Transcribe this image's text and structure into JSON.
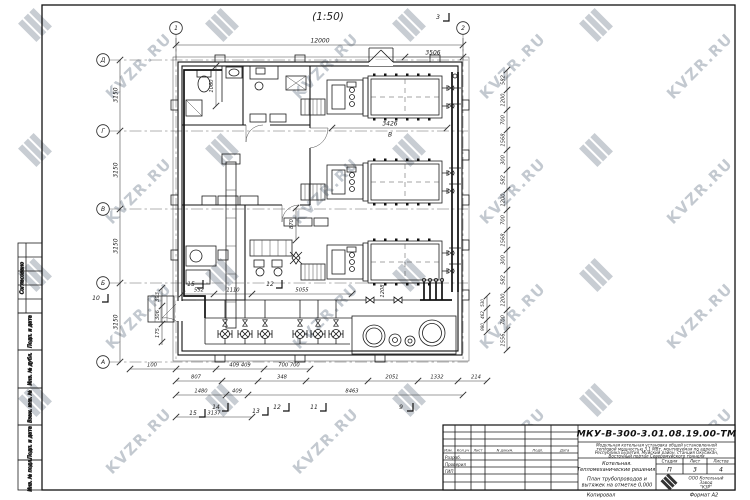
{
  "sheet": {
    "watermark_text": "KVZR.RU",
    "scale_label": "(1:50)",
    "copied_label": "Копировал",
    "format_label": "Формат А2"
  },
  "grid": {
    "cols": [
      "1",
      "2"
    ],
    "rows": [
      "Д",
      "Г",
      "В",
      "Б",
      "А"
    ]
  },
  "dims": {
    "top_overall": "12000",
    "top_right": "3506",
    "boiler_len": "3426",
    "boiler_view_mark": "В",
    "left_floors": [
      "3150",
      "3150",
      "3150",
      "3150"
    ],
    "left_top_inner": "1060",
    "left_small": [
      "393",
      "306",
      "175"
    ],
    "left_bottom": "100",
    "right_chain": [
      "582",
      "1200",
      "700",
      "1568",
      "300",
      "582",
      "1200",
      "700",
      "1568",
      "300",
      "582",
      "1200",
      "700",
      "1556"
    ],
    "right_inner": [
      "530",
      "462",
      "980"
    ],
    "inner_1208": "1208",
    "inner_870": "870",
    "inner_552": "552",
    "inner_1110": "1110",
    "inner_5055": "5055",
    "bottom_409": "409  409",
    "bottom_700": "700   700",
    "bottom_807": "807",
    "bottom_348": "348",
    "bottom_2051": "2051",
    "bottom_1332": "1332",
    "bottom_214": "214",
    "bottom_1480": "1480",
    "bottom_409b": "409",
    "bottom_8463": "8463",
    "bottom_3137": "3137"
  },
  "markers": {
    "top": "3",
    "left": "10",
    "inner_a": "15",
    "inner_b": "12",
    "bottom": [
      "15",
      "14",
      "13",
      "12",
      "11",
      "9"
    ]
  },
  "side_stamp": {
    "sections": [
      "Согласовано",
      "Подп. и дата",
      "Инв. № дубл.",
      "Взам. инв. №",
      "Подп. и дата",
      "Инв. № подл."
    ]
  },
  "title_block": {
    "doc_number": "МКУ-В-300-3.01.08.19.00-ТМ",
    "description_lines": [
      "Модульная котельная установка общей установленной",
      "тепловой мощностью 3,1 МВт, монтируемая по адресу:",
      "Республика Бурятия, Муйский район, станция Окусикан,",
      "Восточный портал Северомуйского тоннеля"
    ],
    "object_line1": "Котельная.",
    "object_line2": "Тепломеханические решения.",
    "sheet_line1": "План трубопроводов и",
    "sheet_line2": "вытяжек на отметке 0,000",
    "stage_label": "Стадия",
    "sheet_label": "Лист",
    "sheets_label": "Листов",
    "stage": "П",
    "sheet": "3",
    "sheets": "4",
    "company_line1": "ООО Котельный",
    "company_line2": "Завод",
    "company_line3": "\"КЗР\"",
    "columns": [
      "Изм.",
      "Кол.уч",
      "Лист",
      "N докум.",
      "Подп.",
      "Дата"
    ],
    "roles": [
      "Разраб.",
      "Проверил",
      "ГИП"
    ]
  }
}
